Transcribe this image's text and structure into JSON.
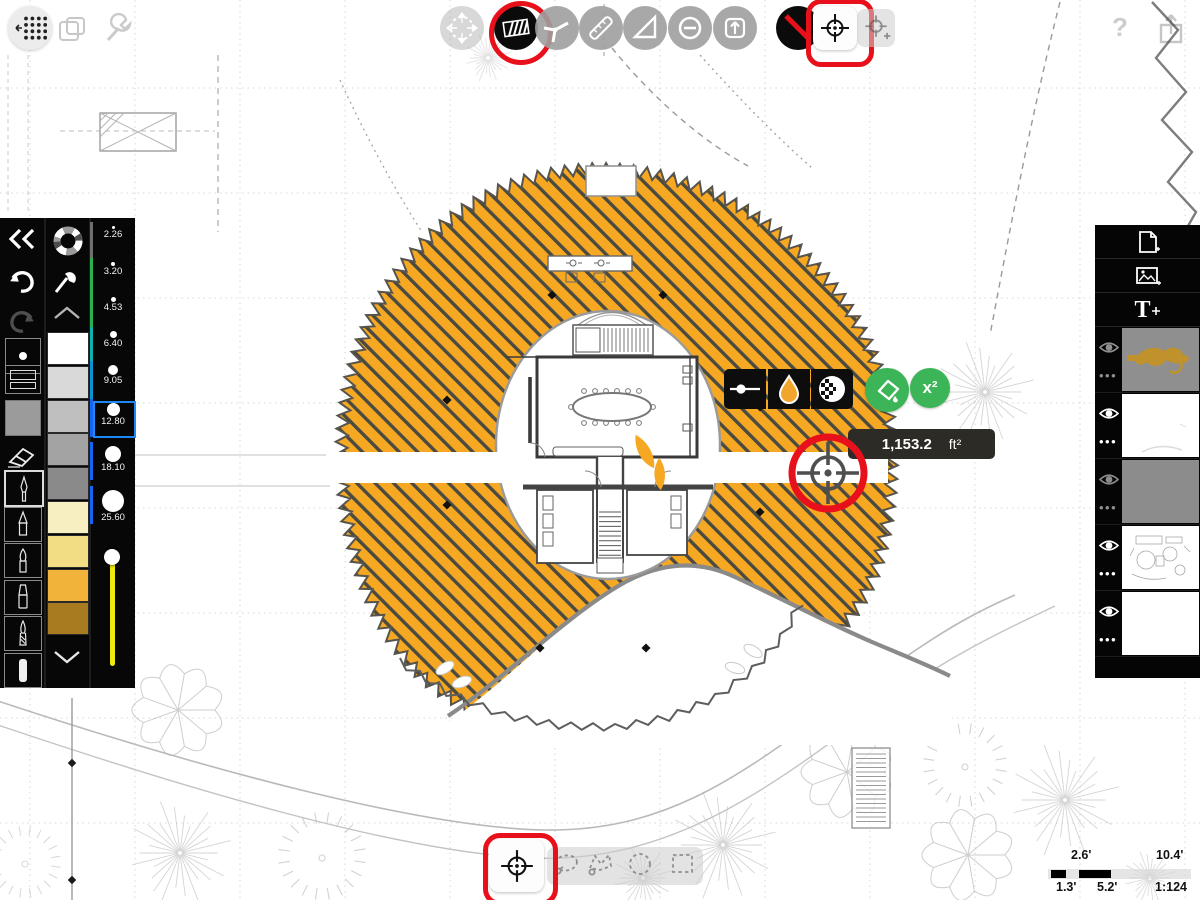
{
  "colors": {
    "accent_red": "#E8111B",
    "selection_blue": "#1E88F7",
    "action_green": "#3BB558",
    "hatch_orange": "#F7A823",
    "hatch_line": "#4A4A40",
    "slider_yellow": "#F0E70C",
    "current_color": "#9B9B9B"
  },
  "top_left_toolbar": {
    "tools": [
      {
        "name": "grid-drag",
        "state": "enabled"
      },
      {
        "name": "duplicate-view",
        "state": "disabled"
      },
      {
        "name": "settings-wrench",
        "state": "disabled"
      }
    ]
  },
  "top_toolbar": {
    "tools": [
      {
        "name": "transform-move",
        "state": "disabled"
      },
      {
        "name": "hatch-fill",
        "state": "active-highlighted"
      },
      {
        "name": "leader-lines",
        "state": "enabled"
      },
      {
        "name": "ruler",
        "state": "enabled"
      },
      {
        "name": "set-square",
        "state": "enabled"
      },
      {
        "name": "subtract-circle",
        "state": "enabled"
      },
      {
        "name": "export-up",
        "state": "enabled"
      },
      {
        "name": "no-fill",
        "state": "enabled"
      },
      {
        "name": "area-target",
        "state": "active-highlighted"
      },
      {
        "name": "area-target-add",
        "state": "disabled"
      }
    ]
  },
  "top_right": {
    "help_label": "?"
  },
  "left_sidebar": {
    "history": {
      "undo_enabled": true,
      "redo_enabled": false
    },
    "stroke_sizes": [
      {
        "label": "2.26",
        "selected": false
      },
      {
        "label": "3.20",
        "selected": false
      },
      {
        "label": "4.53",
        "selected": false
      },
      {
        "label": "6.40",
        "selected": false
      },
      {
        "label": "9.05",
        "selected": false
      },
      {
        "label": "12.80",
        "selected": true
      },
      {
        "label": "18.10",
        "selected": false
      },
      {
        "label": "25.60",
        "selected": false
      }
    ],
    "swatches": [
      "#FFFFFF",
      "#D9D9D9",
      "#BFBFBF",
      "#A3A3A3",
      "#8A8A8A",
      "#F7EFC2",
      "#F2DD85",
      "#F1B33A",
      "#A87B20"
    ],
    "pen_tools": [
      "technical-pen",
      "pencil",
      "ink-pen",
      "marker",
      "paint-brush",
      "airbrush-tube"
    ],
    "selected_pen": "technical-pen"
  },
  "measurement": {
    "value": "1,153.2",
    "unit": "ft²"
  },
  "quick_actions": {
    "bucket": "fill-area",
    "superscript_label": "x²"
  },
  "mini_toolbar": {
    "buttons": [
      "stroke-weight",
      "color-droplet",
      "pattern-opacity"
    ]
  },
  "selection_toolbar": {
    "tools": [
      {
        "name": "target-select",
        "selected": true
      },
      {
        "name": "lasso",
        "selected": false
      },
      {
        "name": "polygon-lasso",
        "selected": false
      },
      {
        "name": "ellipse-select",
        "selected": false
      },
      {
        "name": "rect-select",
        "selected": false
      }
    ]
  },
  "layers_panel": {
    "add_buttons": [
      "new-page",
      "add-image",
      "add-text"
    ],
    "text_tool_label": "T",
    "more_label": "•••",
    "layers": [
      {
        "thumb": "gold-sketch-on-gray",
        "dimmed": true
      },
      {
        "thumb": "white-faint",
        "dimmed": false
      },
      {
        "thumb": "solid-gray",
        "dimmed": true
      },
      {
        "thumb": "plan-sketch",
        "dimmed": false
      },
      {
        "thumb": "blank-white",
        "dimmed": false
      }
    ]
  },
  "scale_bar": {
    "upper_small": "2.6'",
    "upper_large": "10.4'",
    "lower_small": "1.3'",
    "lower_mid": "5.2'",
    "ratio": "1:124"
  }
}
